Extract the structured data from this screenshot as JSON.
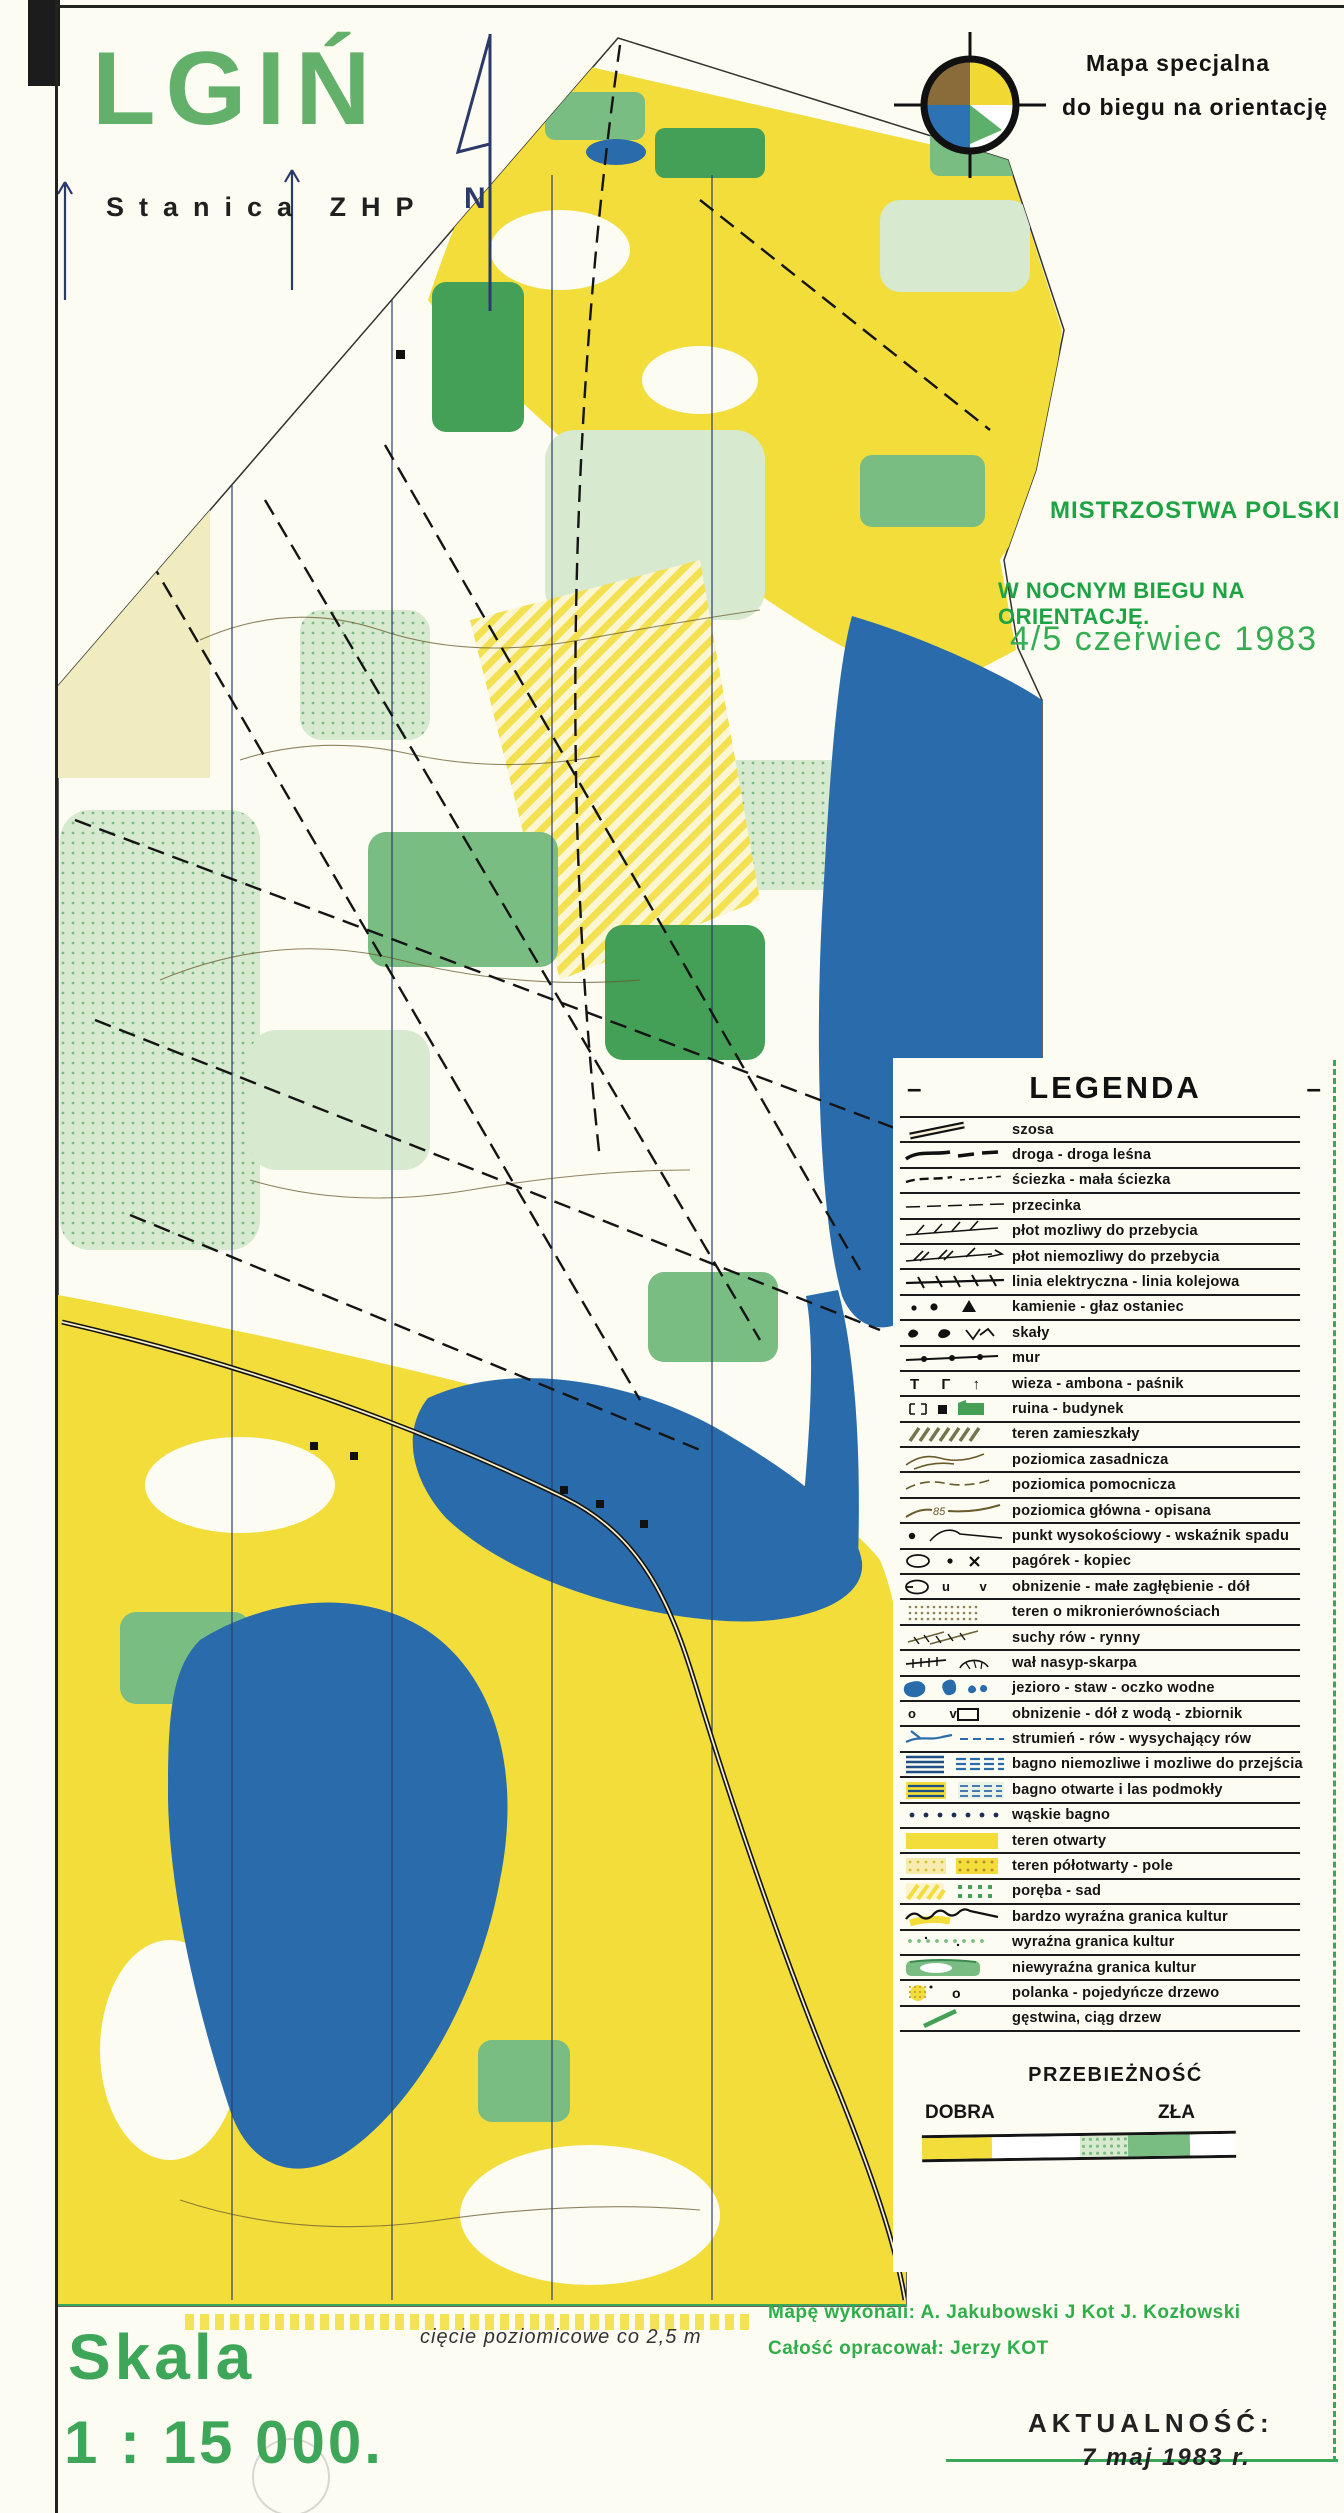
{
  "header": {
    "title": "LGIŃ",
    "subtitle": "Stanica ZHP",
    "map_type_line1": "Mapa specjalna",
    "map_type_line2": "do biegu na orientację",
    "north_label": "N"
  },
  "event": {
    "line1": "MISTRZOSTWA POLSKI",
    "line2": "W NOCNYM BIEGU NA ORIENTACJĘ.",
    "line3": "4/5 czerwiec 1983"
  },
  "legend": {
    "heading": "LEGENDA",
    "dash": "–",
    "items": [
      {
        "label": "szosa",
        "sym": "szosa"
      },
      {
        "label": "droga - droga leśna",
        "sym": "droga"
      },
      {
        "label": "ściezka - mała ściezka",
        "sym": "sciezka"
      },
      {
        "label": "przecinka",
        "sym": "przecinka"
      },
      {
        "label": "płot mozliwy do przebycia",
        "sym": "plot-mozliwy"
      },
      {
        "label": "płot niemozliwy do przebycia",
        "sym": "plot-niemozliwy"
      },
      {
        "label": "linia elektryczna - linia kolejowa",
        "sym": "linia"
      },
      {
        "label": "kamienie - głaz ostaniec",
        "sym": "kamienie"
      },
      {
        "label": "skały",
        "sym": "skaly"
      },
      {
        "label": "mur",
        "sym": "mur"
      },
      {
        "label": "wieza - ambona - paśnik",
        "sym": "wieza",
        "glyph": "T Γ ↑"
      },
      {
        "label": "ruina - budynek",
        "sym": "ruina"
      },
      {
        "label": "teren zamieszkały",
        "sym": "zamieszkaly"
      },
      {
        "label": "poziomica zasadnicza",
        "sym": "poziomica-zasadnicza"
      },
      {
        "label": "poziomica pomocnicza",
        "sym": "poziomica-pomocnicza"
      },
      {
        "label": "poziomica główna - opisana",
        "sym": "poziomica-glowna",
        "glyph": "85"
      },
      {
        "label": "punkt wysokościowy - wskaźnik spadu",
        "sym": "punkt"
      },
      {
        "label": "pagórek - kopiec",
        "sym": "pagorek"
      },
      {
        "label": "obnizenie - małe zagłębienie - dół",
        "sym": "obnizenie",
        "glyph": "u v"
      },
      {
        "label": "teren o mikronierównościach",
        "sym": "mikro"
      },
      {
        "label": "suchy rów - rynny",
        "sym": "suchy-row"
      },
      {
        "label": "wał nasyp-skarpa",
        "sym": "wal"
      },
      {
        "label": "jezioro - staw - oczko wodne",
        "sym": "jezioro"
      },
      {
        "label": "obnizenie - dół z wodą - zbiornik",
        "sym": "obnizenie-woda",
        "glyph": "o v"
      },
      {
        "label": "strumień - rów - wysychający rów",
        "sym": "strumien"
      },
      {
        "label": "bagno niemozliwe i mozliwe do przejścia",
        "sym": "bagno"
      },
      {
        "label": "bagno otwarte i las podmokły",
        "sym": "bagno-otwarte"
      },
      {
        "label": "wąskie bagno",
        "sym": "waskie-bagno"
      },
      {
        "label": "teren otwarty",
        "sym": "teren-otwarty"
      },
      {
        "label": "teren półotwarty - pole",
        "sym": "polotwarty"
      },
      {
        "label": "poręba - sad",
        "sym": "poreba"
      },
      {
        "label": "bardzo wyraźna granica kultur",
        "sym": "granica-bardzo"
      },
      {
        "label": "wyraźna granica kultur",
        "sym": "granica-wyrazna"
      },
      {
        "label": "niewyraźna granica kultur",
        "sym": "granica-niewyrazna"
      },
      {
        "label": "polanka - pojedyńcze drzewo",
        "sym": "polanka",
        "glyph": "o"
      },
      {
        "label": "gęstwina, ciąg drzew",
        "sym": "gestwina"
      }
    ],
    "runnability": {
      "heading": "PRZEBIEŻNOŚĆ",
      "good": "DOBRA",
      "bad": "ZŁA"
    }
  },
  "footer": {
    "scale_label": "Skala",
    "scale_value": "1 : 15 000.",
    "contour_note": "cięcie poziomicowe co 2,5  m",
    "credits_line1": "Mapę wykonali:  A. Jakubowski   J Kot   J. Kozłowski",
    "credits_line2": "Całość opracował:  Jerzy KOT",
    "currency_label": "AKTUALNOŚĆ:",
    "currency_value": "7 maj 1983 r."
  },
  "colors": {
    "paper": "#fcfcf3",
    "title_green": "#63b06b",
    "stamp_green": "#1ea344",
    "credit_green": "#2fae4a",
    "scale_green": "#3da659",
    "frame_green": "#3aa65a",
    "yellow": "#f3dd3b",
    "yellow_pale": "#f1ecc0",
    "green_mid": "#79bd83",
    "green_dark": "#44a057",
    "green_pale": "#d7e9cf",
    "lake": "#2a6cab",
    "lake_dark": "#1e4f86",
    "contour": "#6a5b2e",
    "north_blue": "#2b3a6b",
    "ink": "#1a1a1a"
  }
}
